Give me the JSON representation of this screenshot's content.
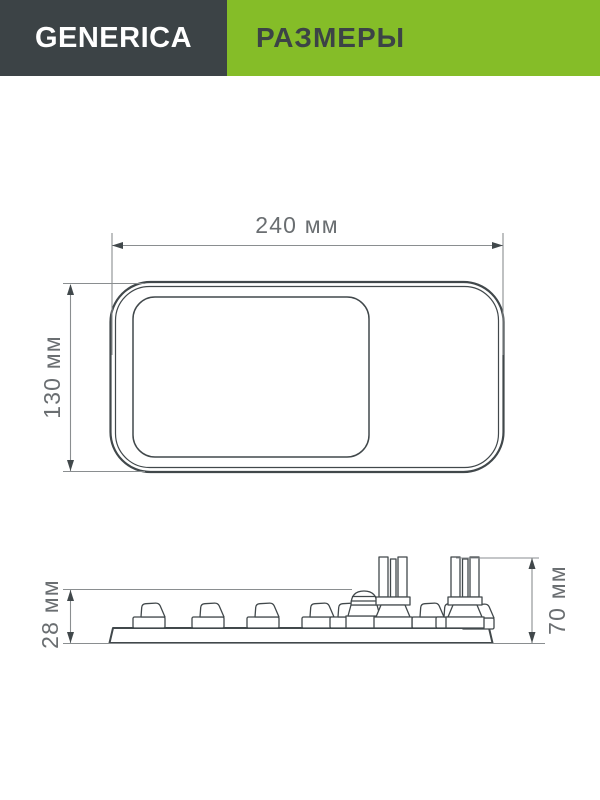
{
  "header": {
    "brand": "GENERICA",
    "title": "РАЗМЕРЫ"
  },
  "diagram": {
    "description": "product dimension drawing, top view and side profile view",
    "views": [
      "top-view",
      "side-profile-view"
    ]
  },
  "dimensions": {
    "width": "240 мм",
    "height": "130 мм",
    "profile_height": "28 мм",
    "total_height": "70 мм"
  },
  "colors": {
    "brand-bg": "#3C4346",
    "accent": "#85BD28",
    "brand-text": "#FFFFFF",
    "title-text": "#3C4346",
    "line": "#41484B",
    "dim-line": "#8A8E90",
    "dim-text": "#6A6E71",
    "bg": "#FFFFFF"
  }
}
